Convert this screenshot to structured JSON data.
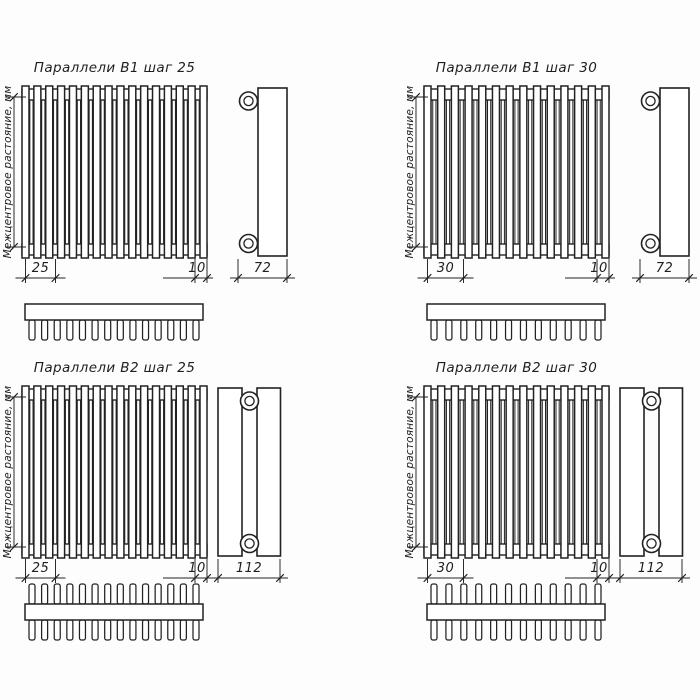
{
  "colors": {
    "line": "#222222",
    "background": "#fdfdfd",
    "fill": "#ffffff"
  },
  "labels": {
    "center_distance": "Межцентровое растояние, мм"
  },
  "panels": [
    {
      "title": "Параллели В1 шаг 25",
      "dims": {
        "step": "25",
        "tube_width": "10",
        "depth": "72"
      },
      "geometry": {
        "rows": 1,
        "step_mm": 25,
        "front_tubes": 16,
        "top_tubes": 14
      }
    },
    {
      "title": "Параллели В1 шаг 30",
      "dims": {
        "step": "30",
        "tube_width": "10",
        "depth": "72"
      },
      "geometry": {
        "rows": 1,
        "step_mm": 30,
        "front_tubes": 14,
        "top_tubes": 12
      }
    },
    {
      "title": "Параллели В2 шаг 25",
      "dims": {
        "step": "25",
        "tube_width": "10",
        "depth": "112"
      },
      "geometry": {
        "rows": 2,
        "step_mm": 25,
        "front_tubes": 16,
        "top_tubes": 14
      }
    },
    {
      "title": "Параллели В2 шаг 30",
      "dims": {
        "step": "30",
        "tube_width": "10",
        "depth": "112"
      },
      "geometry": {
        "rows": 2,
        "step_mm": 30,
        "front_tubes": 14,
        "top_tubes": 12
      }
    }
  ]
}
